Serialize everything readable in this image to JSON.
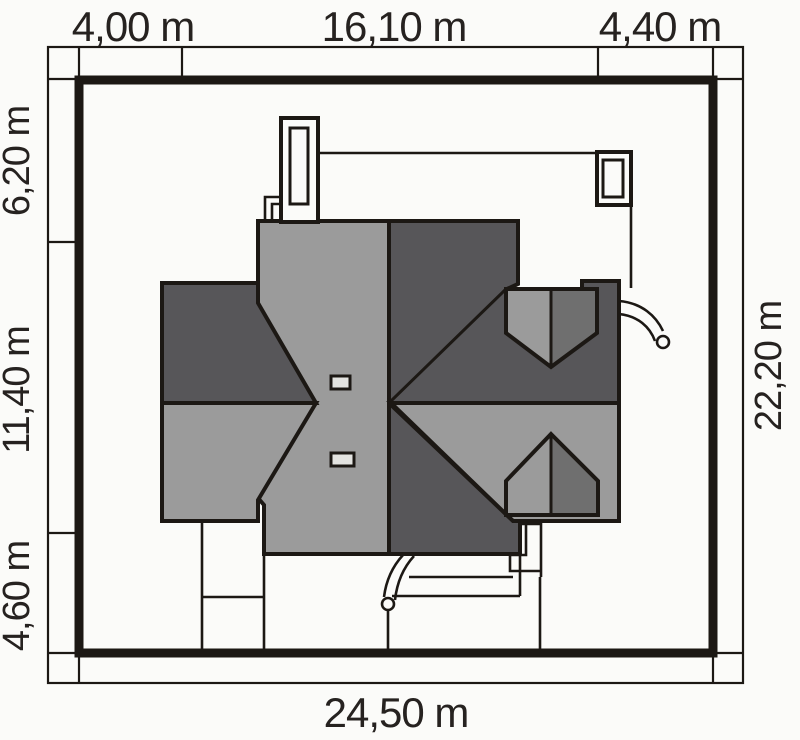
{
  "plan": {
    "dim_top": [
      "4,00 m",
      "16,10 m",
      "4,40 m"
    ],
    "dim_left": [
      "6,20 m",
      "11,40 m",
      "4,60 m"
    ],
    "dim_right": "22,20 m",
    "dim_bottom": "24,50 m"
  },
  "colors": {
    "background": "#fbfbf9",
    "line": "#1c1814",
    "roof_light": "#9b9b9b",
    "roof_mid": "#6f6f6f",
    "roof_dark": "#575659",
    "detail_fill": "#e3e3e0",
    "text": "#262220"
  }
}
